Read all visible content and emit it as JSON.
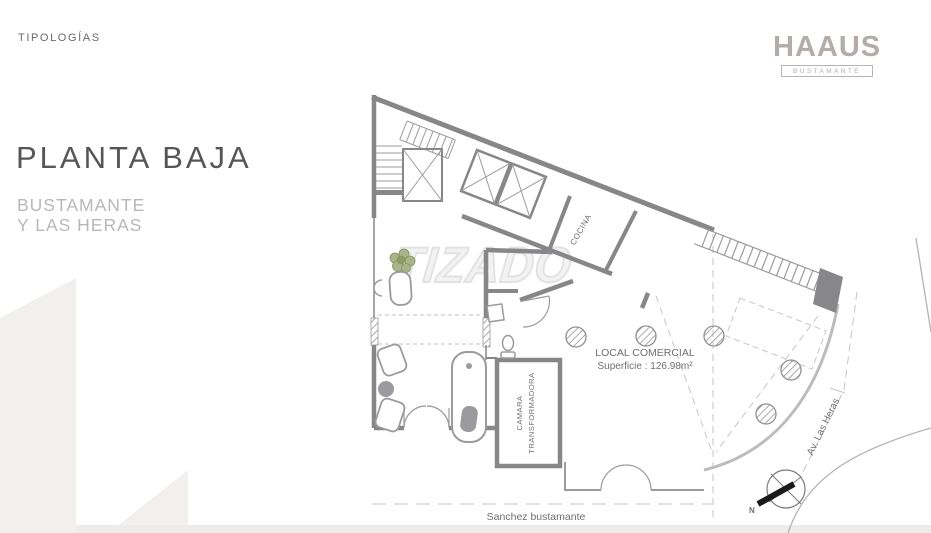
{
  "page": {
    "eyebrow": "TIPOLOGÍAS",
    "title": "PLANTA BAJA",
    "subtitle_line1": "BUSTAMANTE",
    "subtitle_line2": "Y LAS HERAS",
    "watermark": "TIZADO"
  },
  "brand": {
    "logo": "HAAUS",
    "tagline": "BUSTAMANTE"
  },
  "floorplan": {
    "labels": {
      "kitchen": "COCINA",
      "commercial_title": "LOCAL COMERCIAL",
      "commercial_area": "Superficie : 126.98m²",
      "transformer_line1": "CAMARA",
      "transformer_line2": "TRANSFORMADORA",
      "street_bottom": "Sanchez bustamante",
      "street_right": "Av. Las Heras",
      "compass_north": "N"
    },
    "colors": {
      "wall": "#87878a",
      "fixture_line": "#9b9b9d",
      "dashed_line": "#c6c6c6",
      "facade_glass": "#bcbcbc",
      "plant_green": "#8e9d68",
      "brand_gray": "#b2adaa",
      "title_gray": "#55565a",
      "subtitle_gray": "#bab7b4",
      "watermark_outline": "#e2e2e2",
      "deco_shape": "#f1f0ee"
    }
  }
}
